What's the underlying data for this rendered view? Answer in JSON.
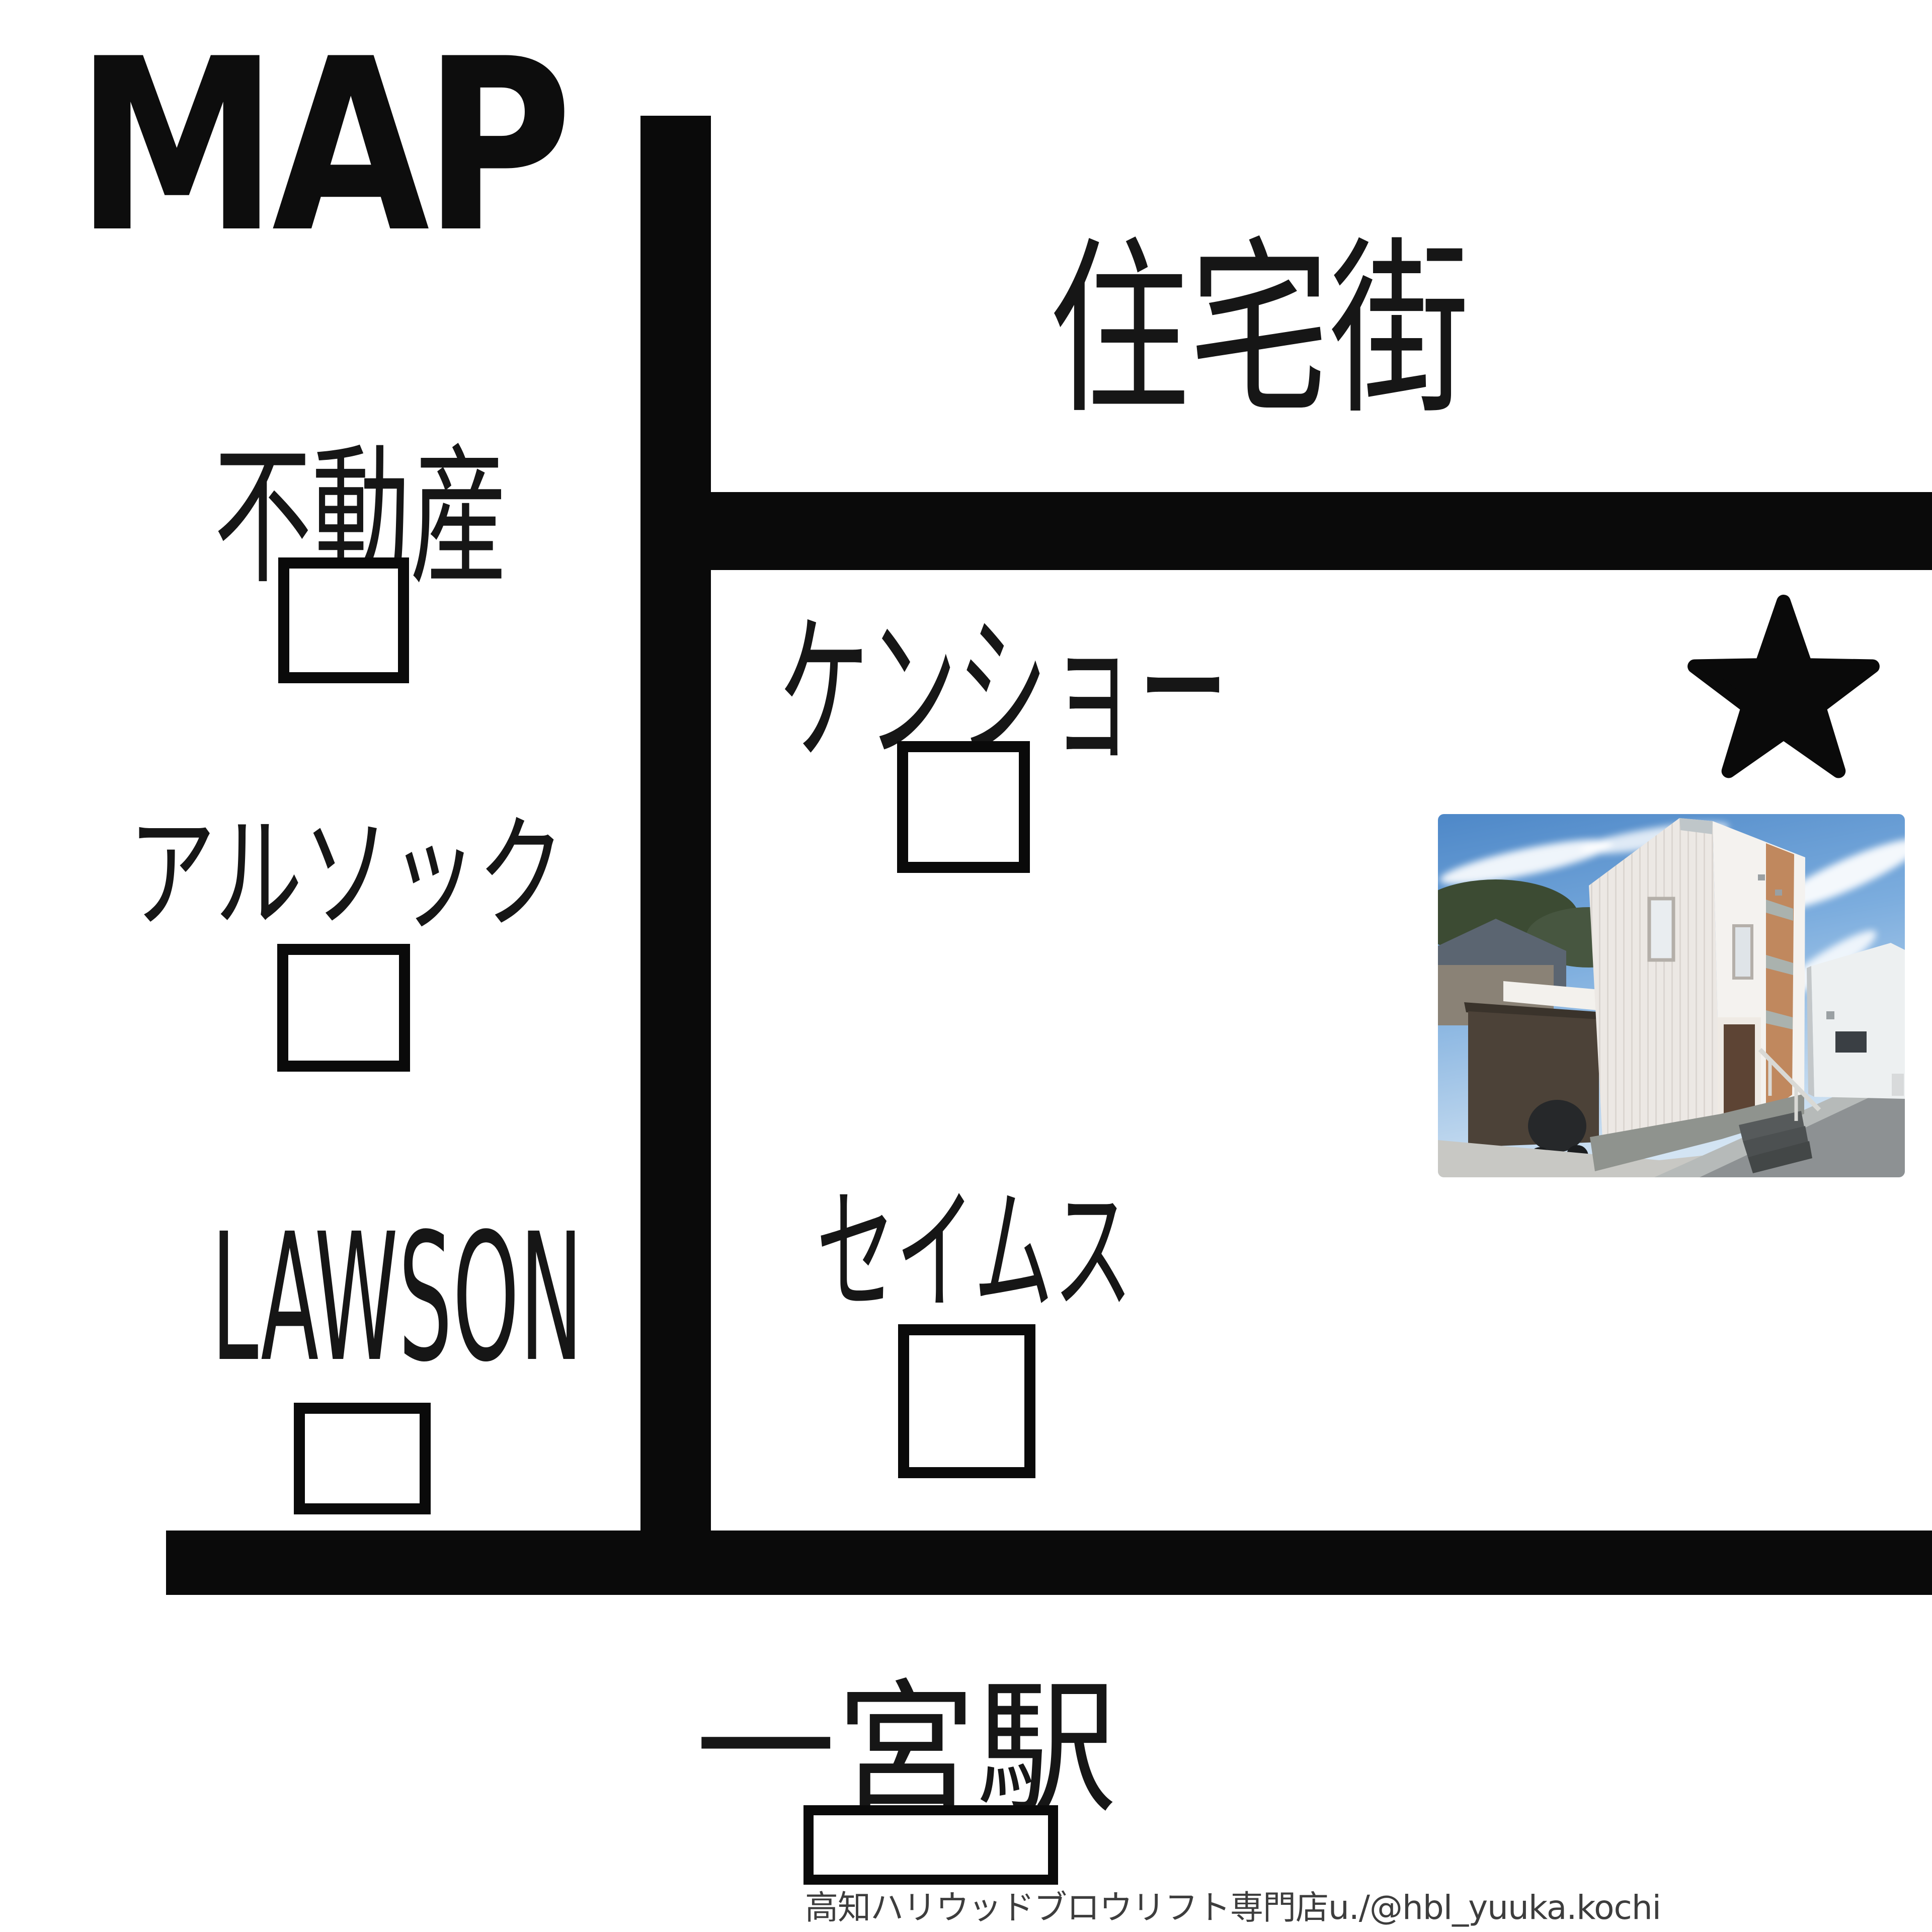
{
  "page": {
    "title": "MAP"
  },
  "map": {
    "area_label": "住宅街",
    "landmarks": {
      "fudosan": "不動産",
      "alsok": "アルソック",
      "lawson": "LAWSON",
      "kensho": "ケンショー",
      "seims": "セイムス",
      "station": "一宮駅"
    },
    "marker_icon": "star-icon",
    "colors": {
      "road": "#0a0a0a",
      "background": "#ffffff",
      "label_text": "#161616",
      "watermark_text": "#3d3d3d"
    }
  },
  "photo": {
    "alt": "two-story white shop building with orange accent under blue sky"
  },
  "watermark": "高知ハリウッドブロウリフト専門店u./@hbl_yuuka.kochi"
}
